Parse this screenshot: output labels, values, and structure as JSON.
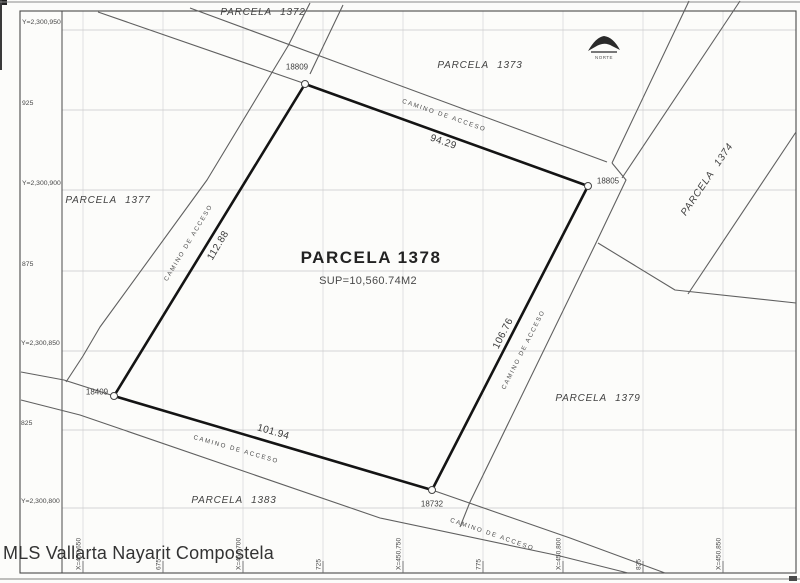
{
  "document": {
    "type_note": "scanned cadastral parcel plan",
    "watermark": "MLS Vallarta Nayarit Compostela",
    "north_label": "NORTE",
    "road_label": "CAMINO DE ACCESO"
  },
  "axis": {
    "y_labels": [
      "Y=2,300,950",
      "925",
      "Y=2,300,900",
      "875",
      "Y=2,300,850",
      "825",
      "Y=2,300,800"
    ],
    "x_labels": [
      "X=450,650",
      "675",
      "X=450,700",
      "725",
      "X=450,750",
      "775",
      "X=450,800",
      "825",
      "X=450,850"
    ]
  },
  "main_parcel": {
    "name": "PARCELA 1378",
    "area": "SUP=10,560.74M2"
  },
  "parcels": [
    "PARCELA 1372",
    "PARCELA 1373",
    "PARCELA 1374",
    "PARCELA 1377",
    "PARCELA 1379",
    "PARCELA 1383"
  ],
  "points": [
    "18809",
    "18805",
    "18732",
    "18409"
  ],
  "dimensions": [
    "94.29",
    "106.76",
    "101.94",
    "112.88"
  ],
  "colors": {
    "parcel_outline": "#141414",
    "road_line": "#606060",
    "frame": "#4a4a4a",
    "grid": "#c8c8c8",
    "text": "#3c3c3c"
  }
}
